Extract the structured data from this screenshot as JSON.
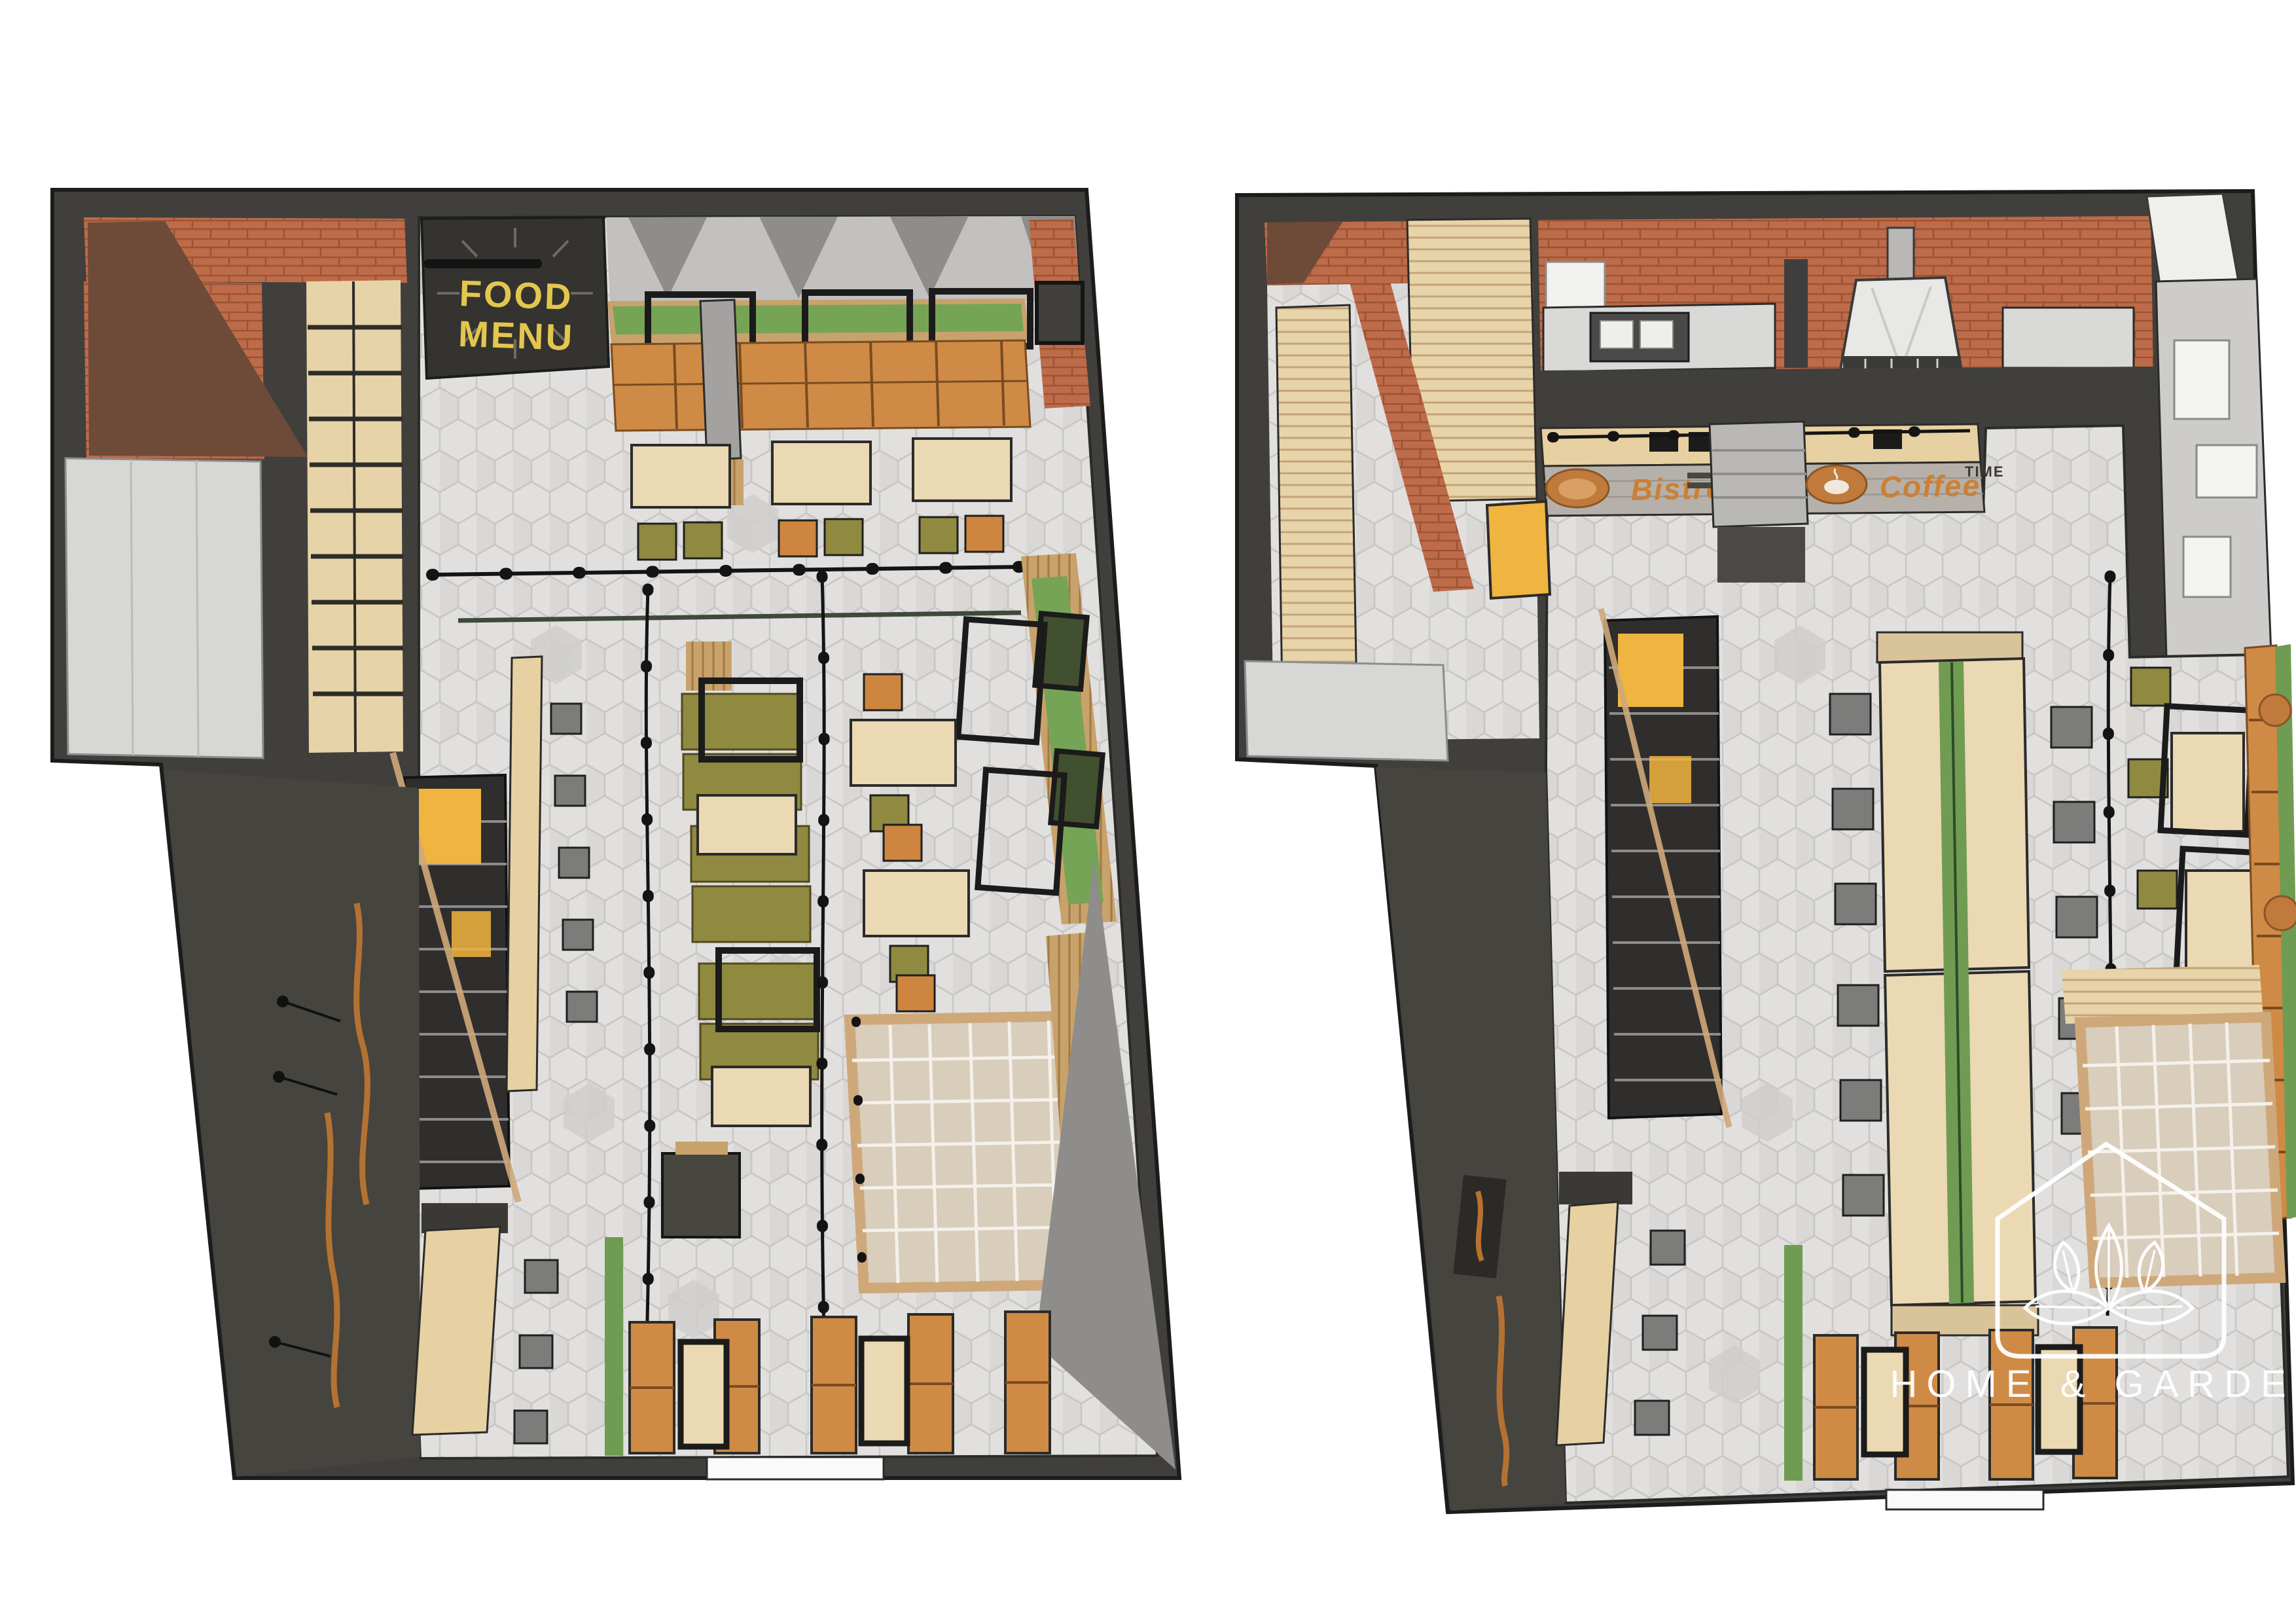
{
  "palette": {
    "background": "#ffffff",
    "wall_dark": "#413f3c",
    "wall_wedge": "#46443f",
    "brick": "#bd6b49",
    "brick_line": "#9a5334",
    "brick_dark_wood": "#6e4a39",
    "wood_light": "#ead9b3",
    "wood_mid": "#c9a26b",
    "counter_wood": "#e7d0a2",
    "booth_orange": "#cf8a45",
    "chair_orange": "#cd853f",
    "olive": "#8f8a3f",
    "plant_green": "#6f9c52",
    "planter_green": "#76a457",
    "accent_yellow": "#f0b440",
    "floor_light": "#e1e0de",
    "floor_shade": "#d2d1cf",
    "metal_gray": "#d9d9d7",
    "stool_gray": "#7c7c7a",
    "ceiling_gray": "#c2c1bf",
    "ceiling_dark": "#8e8d8b",
    "black": "#141414",
    "sign_yellow": "#e3c64f",
    "sign_orange": "#cd7f35",
    "watermark_white": "#ffffff"
  },
  "plans": {
    "left": {
      "signs": {
        "food_menu_line1": "FOOD",
        "food_menu_line2": "MENU"
      }
    },
    "right": {
      "signs": {
        "bistro_label": "Bistro",
        "coffee_label": "Coffee",
        "coffee_sublabel": "TIME"
      }
    }
  },
  "watermark": {
    "text": "HOME & GARDEN"
  }
}
